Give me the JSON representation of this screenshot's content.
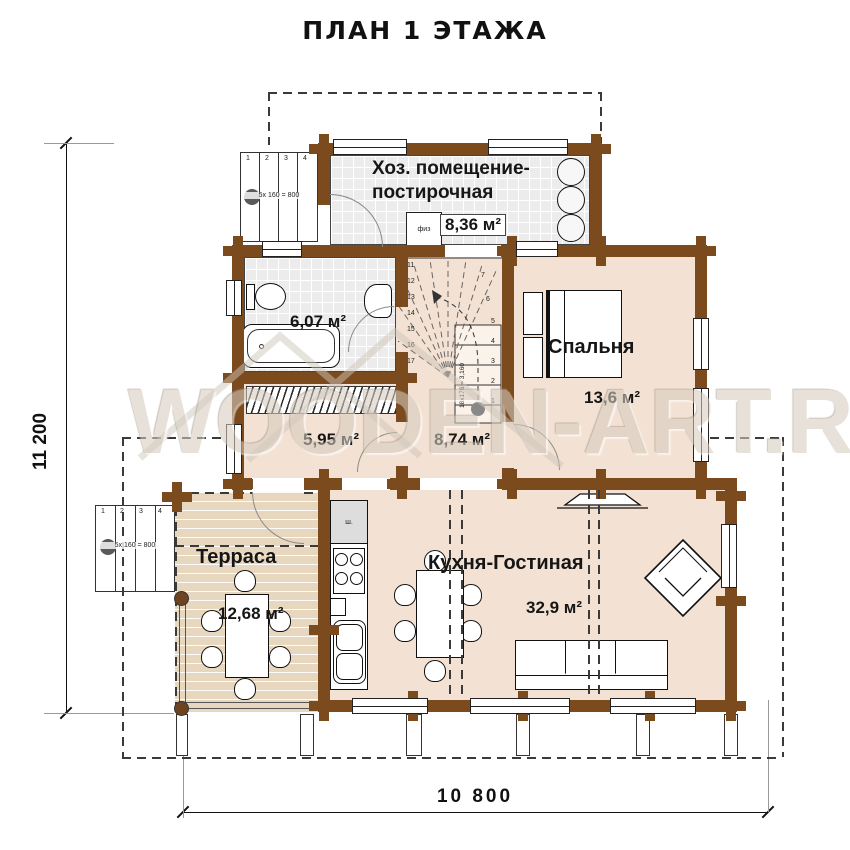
{
  "title": "ПЛАН 1 ЭТАЖА",
  "watermark": "WOODEN-ART.RU",
  "dimensions": {
    "height": "11 200",
    "width": "10 800"
  },
  "rooms": {
    "utility": {
      "name_line1": "Хоз. помещение-",
      "name_line2": "постирочная",
      "area": "8,36 м²"
    },
    "bathroom": {
      "area": "6,07 м²"
    },
    "bedroom": {
      "name": "Спальня",
      "area": "13,6 м²"
    },
    "dressing": {
      "area": "5,95 м²"
    },
    "hall": {
      "area": "8,74 м²"
    },
    "terrace": {
      "name": "Терраса",
      "area": "12,68 м²"
    },
    "kitchen": {
      "name": "Кухня-Гостиная",
      "area": "32,9 м²"
    }
  },
  "stairs": {
    "note": "18х176 = 3,160",
    "steps_right": [
      "1",
      "2",
      "3",
      "4",
      "5"
    ],
    "steps_upper": [
      "6",
      "7"
    ],
    "steps_left": [
      "11",
      "12",
      "13",
      "14",
      "15",
      "16",
      "17"
    ]
  },
  "porch_top": {
    "note": "5х 160 = 800",
    "steps": [
      "1",
      "2",
      "3",
      "4"
    ]
  },
  "porch_left": {
    "note": "5х 160 = 800",
    "steps": [
      "1",
      "2",
      "3",
      "4"
    ]
  },
  "small_labels": {
    "utility_box": "физ",
    "kitchen_cabinet": "ш."
  }
}
